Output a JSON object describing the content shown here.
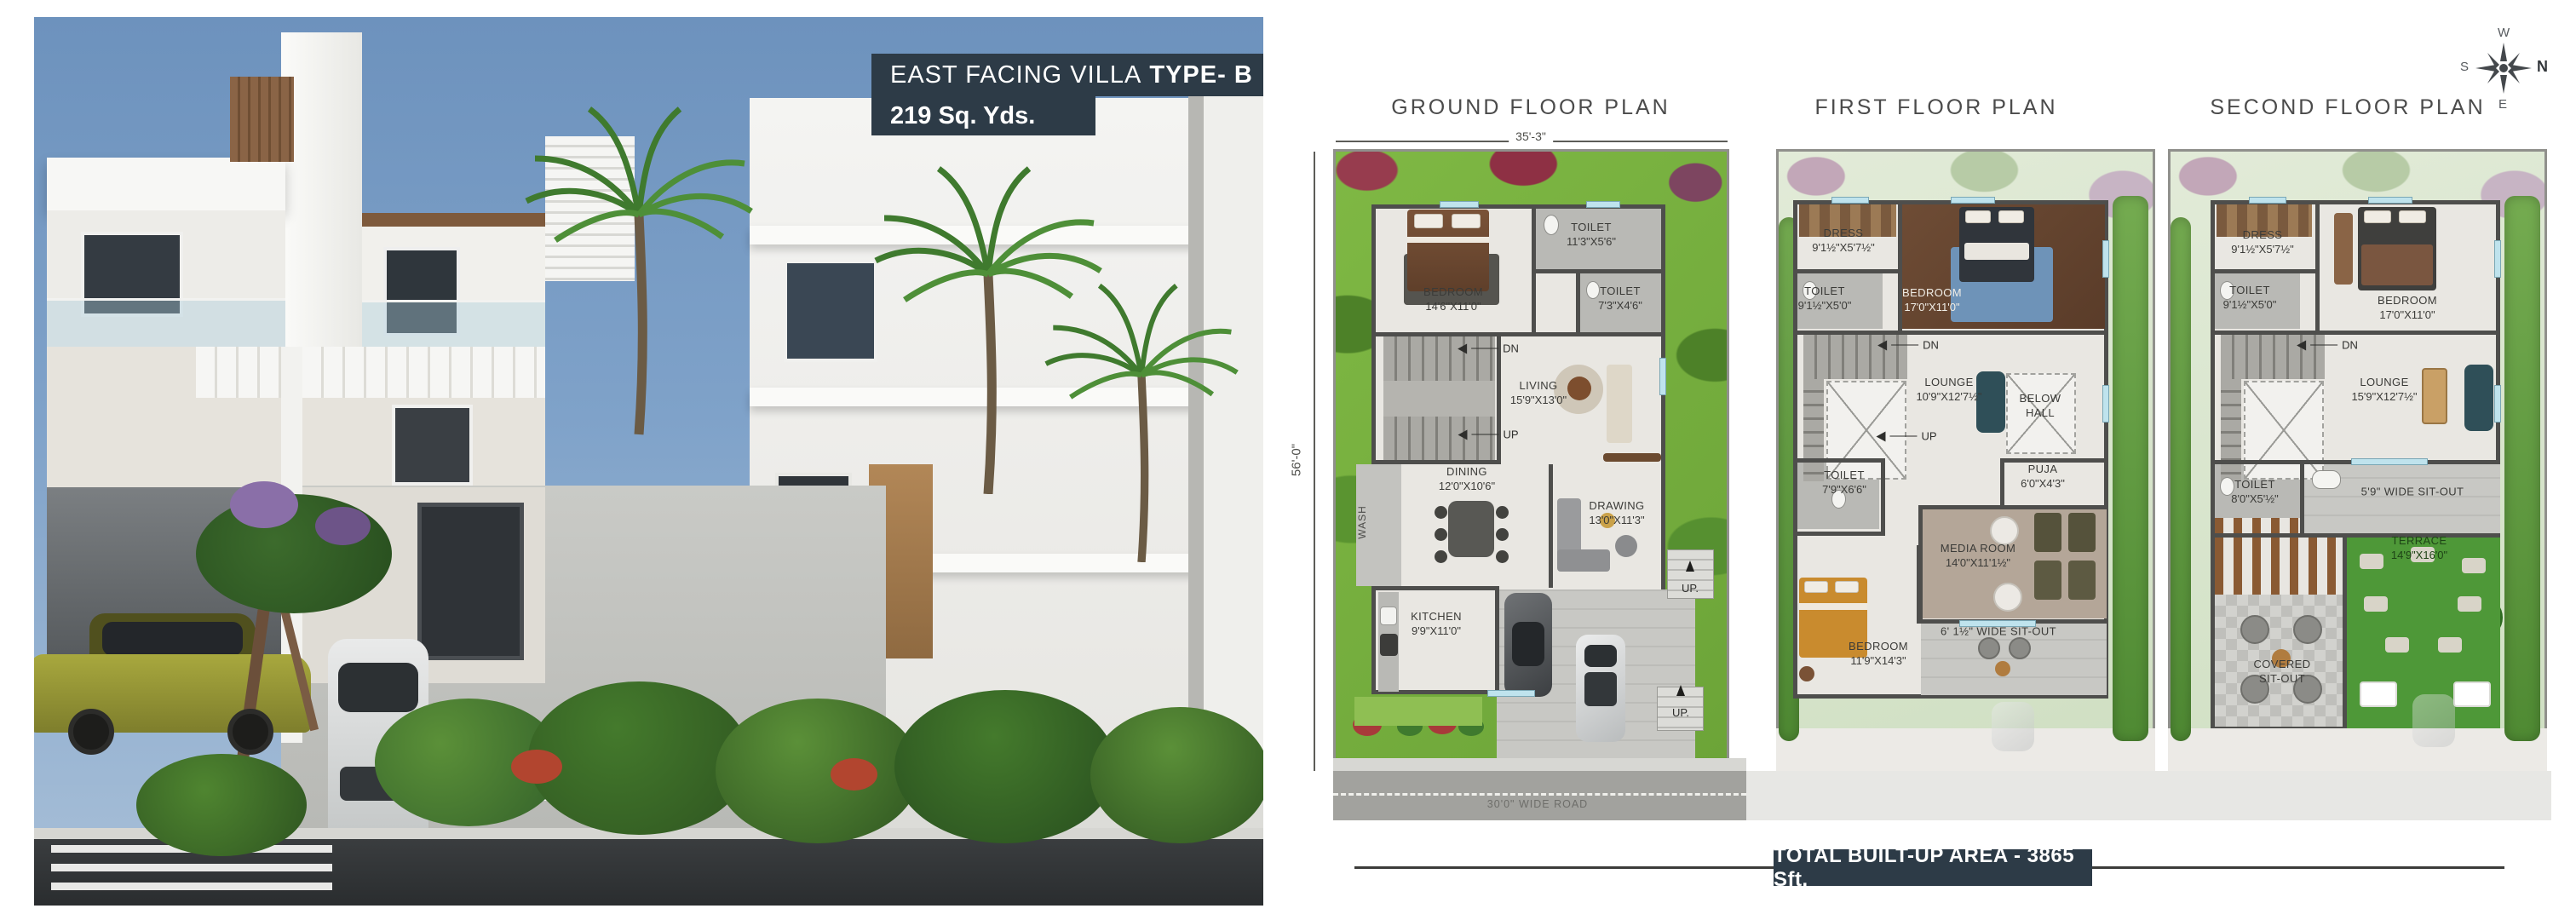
{
  "hero": {
    "title_regular": "EAST FACING VILLA",
    "title_bold": "TYPE- B",
    "subtitle": "219 Sq. Yds."
  },
  "compass": {
    "n": "N",
    "s": "S",
    "e": "E",
    "w": "W"
  },
  "footer": {
    "total_area": "TOTAL BUILT-UP AREA - 3865 Sft."
  },
  "colors": {
    "banner": "#2d3b47",
    "wall": "#4e4e4c",
    "garden_green": "#79b23e",
    "terrace_green": "#4e9838",
    "wood": "#8a6a4e",
    "sky": "#7496bf"
  },
  "plans": [
    {
      "title": "GROUND FLOOR PLAN",
      "dim_width": "35'-3\"",
      "dim_height": "56'-0\"",
      "rooms": {
        "bedroom": {
          "name": "BEDROOM",
          "dim": "14'6\"X11'0\""
        },
        "toilet_top": {
          "name": "TOILET",
          "dim": "11'3\"X5'6\""
        },
        "toilet_mid": {
          "name": "TOILET",
          "dim": "7'3\"X4'6\""
        },
        "living": {
          "name": "LIVING",
          "dim": "15'9\"X13'0\""
        },
        "dining": {
          "name": "DINING",
          "dim": "12'0\"X10'6\""
        },
        "drawing": {
          "name": "DRAWING",
          "dim": "13'0\"X11'3\""
        },
        "kitchen": {
          "name": "KITCHEN",
          "dim": "9'9\"X11'0\""
        },
        "wash": {
          "name": "WASH"
        }
      },
      "labels": {
        "dn": "DN",
        "up": "UP",
        "up_entry": "UP.",
        "road": "30'0\" WIDE ROAD"
      }
    },
    {
      "title": "FIRST FLOOR PLAN",
      "rooms": {
        "dress": {
          "name": "DRESS",
          "dim": "9'1½\"X5'7½\""
        },
        "toilet_top": {
          "name": "TOILET",
          "dim": "9'1½\"X5'0\""
        },
        "bedroom_top": {
          "name": "BEDROOM",
          "dim": "17'0\"X11'0\""
        },
        "lounge": {
          "name": "LOUNGE",
          "dim": "10'9\"X12'7½\""
        },
        "below_hall": {
          "line1": "BELOW",
          "line2": "HALL"
        },
        "toilet_mid": {
          "name": "TOILET",
          "dim": "7'9\"X6'6\""
        },
        "puja": {
          "name": "PUJA",
          "dim": "6'0\"X4'3\""
        },
        "media": {
          "name": "MEDIA ROOM",
          "dim": "14'0\"X11'1½\""
        },
        "bedroom_bottom": {
          "name": "BEDROOM",
          "dim": "11'9\"X14'3\""
        },
        "sitout": {
          "name": "6' 1½\" WIDE SIT-OUT"
        }
      },
      "labels": {
        "dn": "DN",
        "up": "UP"
      }
    },
    {
      "title": "SECOND FLOOR PLAN",
      "rooms": {
        "dress": {
          "name": "DRESS",
          "dim": "9'1½\"X5'7½\""
        },
        "toilet_top": {
          "name": "TOILET",
          "dim": "9'1½\"X5'0\""
        },
        "bedroom": {
          "name": "BEDROOM",
          "dim": "17'0\"X11'0\""
        },
        "lounge": {
          "name": "LOUNGE",
          "dim": "15'9\"X12'7½\""
        },
        "toilet_mid": {
          "name": "TOILET",
          "dim": "8'0\"X5'½\""
        },
        "sitout": {
          "name": "5'9\" WIDE SIT-OUT"
        },
        "terrace": {
          "name": "TERRACE",
          "dim": "14'9\"X16'0\""
        },
        "covered_sitout": {
          "line1": "COVERED",
          "line2": "SIT-OUT"
        }
      },
      "labels": {
        "dn": "DN"
      }
    }
  ]
}
